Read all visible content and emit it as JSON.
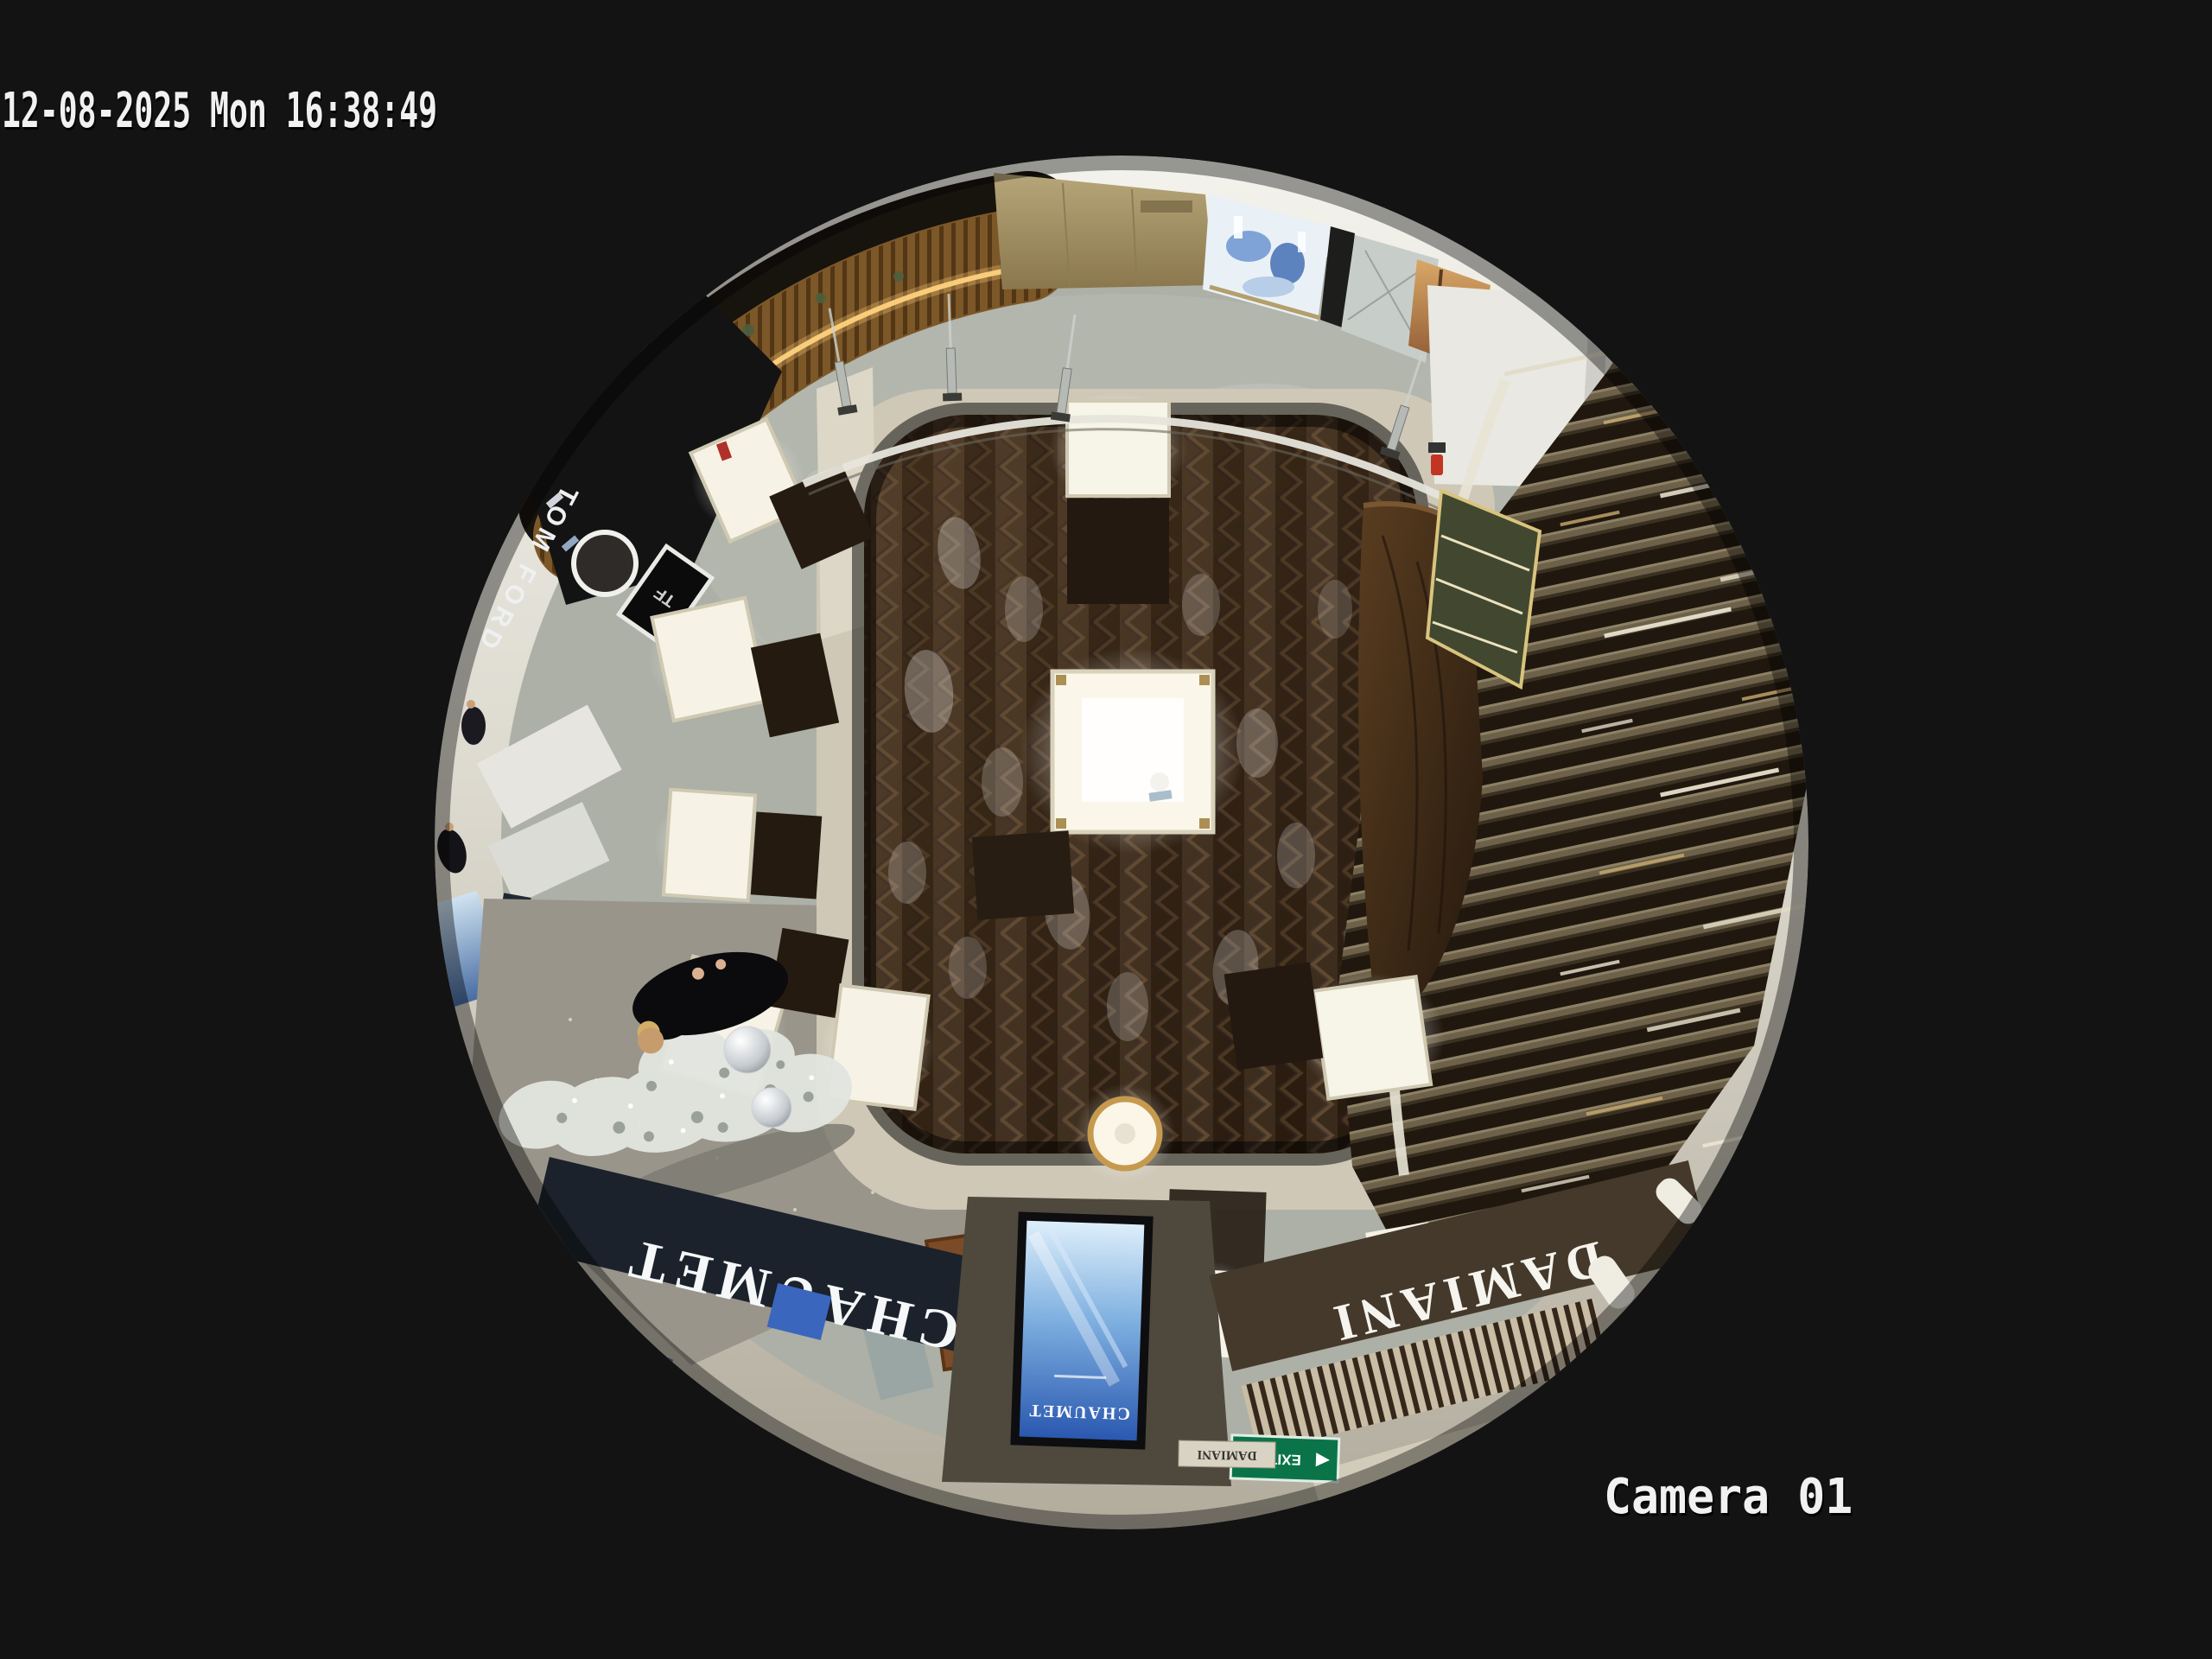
{
  "osd": {
    "timestamp": "12-08-2025 Mon 16:38:49",
    "camera_label": "Camera 01",
    "text_color": "#f1f1f1"
  },
  "scene": {
    "view_type": "ceiling fisheye 360 camera",
    "location": "luxury jewelry boutique facing a mall corridor",
    "signs": {
      "chaumet": "CHAUMET",
      "damiani": "DAMIANI",
      "tom_ford": "TOM FORD",
      "tf_monogram": "TF",
      "la_mer": "LA MER",
      "screen_brand": "CHAUMET",
      "exit": "EXIT",
      "damiani_plaque": "DAMIANI"
    },
    "colors": {
      "background": "#131313",
      "rim_ceiling": "#f3f2ec",
      "wood_floor": "#3a2a1b",
      "corridor_marble": "#adb0a6",
      "plaza_stone": "#99958b",
      "chaumet_fascia": "#1b222b",
      "damiani_fascia": "#44392b",
      "screen_blue": "#2a58b0",
      "exit_green": "#0a7448",
      "kiosk_wood": "#7c5728",
      "led_amber": "#ffd27e",
      "alarm_red": "#c23522"
    }
  }
}
